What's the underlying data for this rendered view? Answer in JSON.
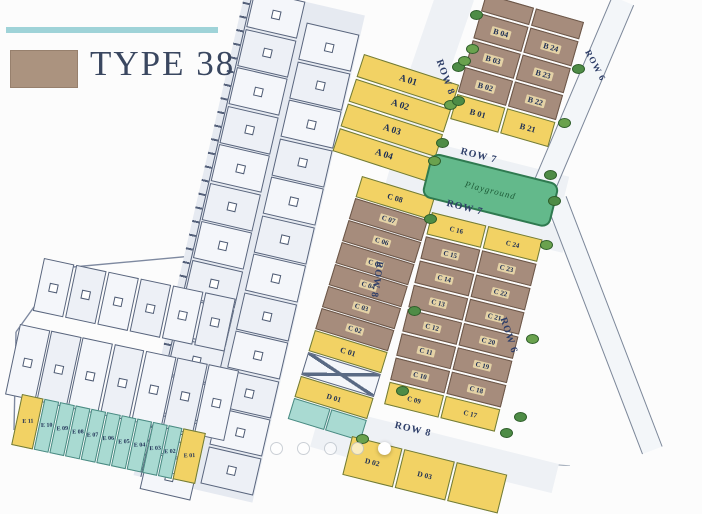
{
  "legend": {
    "label": "TYPE 38"
  },
  "park": {
    "label": "Playground"
  },
  "row_labels": [
    "ROW 8",
    "ROW 6",
    "ROW 7",
    "ROW 7",
    "ROW 8",
    "ROW 6",
    "ROW 8"
  ],
  "lots": {
    "a_column": [
      "A 01",
      "A 02",
      "A 03",
      "A 04"
    ],
    "b_left": [
      "B 04",
      "B 03",
      "B 02",
      "B 01"
    ],
    "b_right": [
      "B 24",
      "B 23",
      "B 22",
      "B 21"
    ],
    "c_middle": [
      "C 08",
      "C 07",
      "C 06",
      "C 05",
      "C 04",
      "C 03",
      "C 02",
      "C 01"
    ],
    "c_right_left": [
      "C 16",
      "C 15",
      "C 14",
      "C 13",
      "C 12",
      "C 11",
      "C 10",
      "C 09"
    ],
    "c_right_right": [
      "C 24",
      "C 23",
      "C 22",
      "C 21",
      "C 20",
      "C 19",
      "C 18",
      "C 17"
    ],
    "d_left": "D 01",
    "d_bottom": [
      "D 02",
      "D 03"
    ],
    "e_strip": [
      "E 11",
      "E 10",
      "E 09",
      "E 08",
      "E 07",
      "E 06",
      "E 05",
      "E 04",
      "E 03",
      "E 02",
      "E 01"
    ]
  },
  "carousel": {
    "dot_count": 5,
    "active_index": 4
  },
  "colors": {
    "lot_yellow": "#f2d264",
    "lot_brown": "#a68c7c",
    "lot_teal": "#a9dad2",
    "park_green": "#63b98b",
    "legend_swatch": "#ab937f",
    "accent_teal": "#9fd3d8"
  }
}
